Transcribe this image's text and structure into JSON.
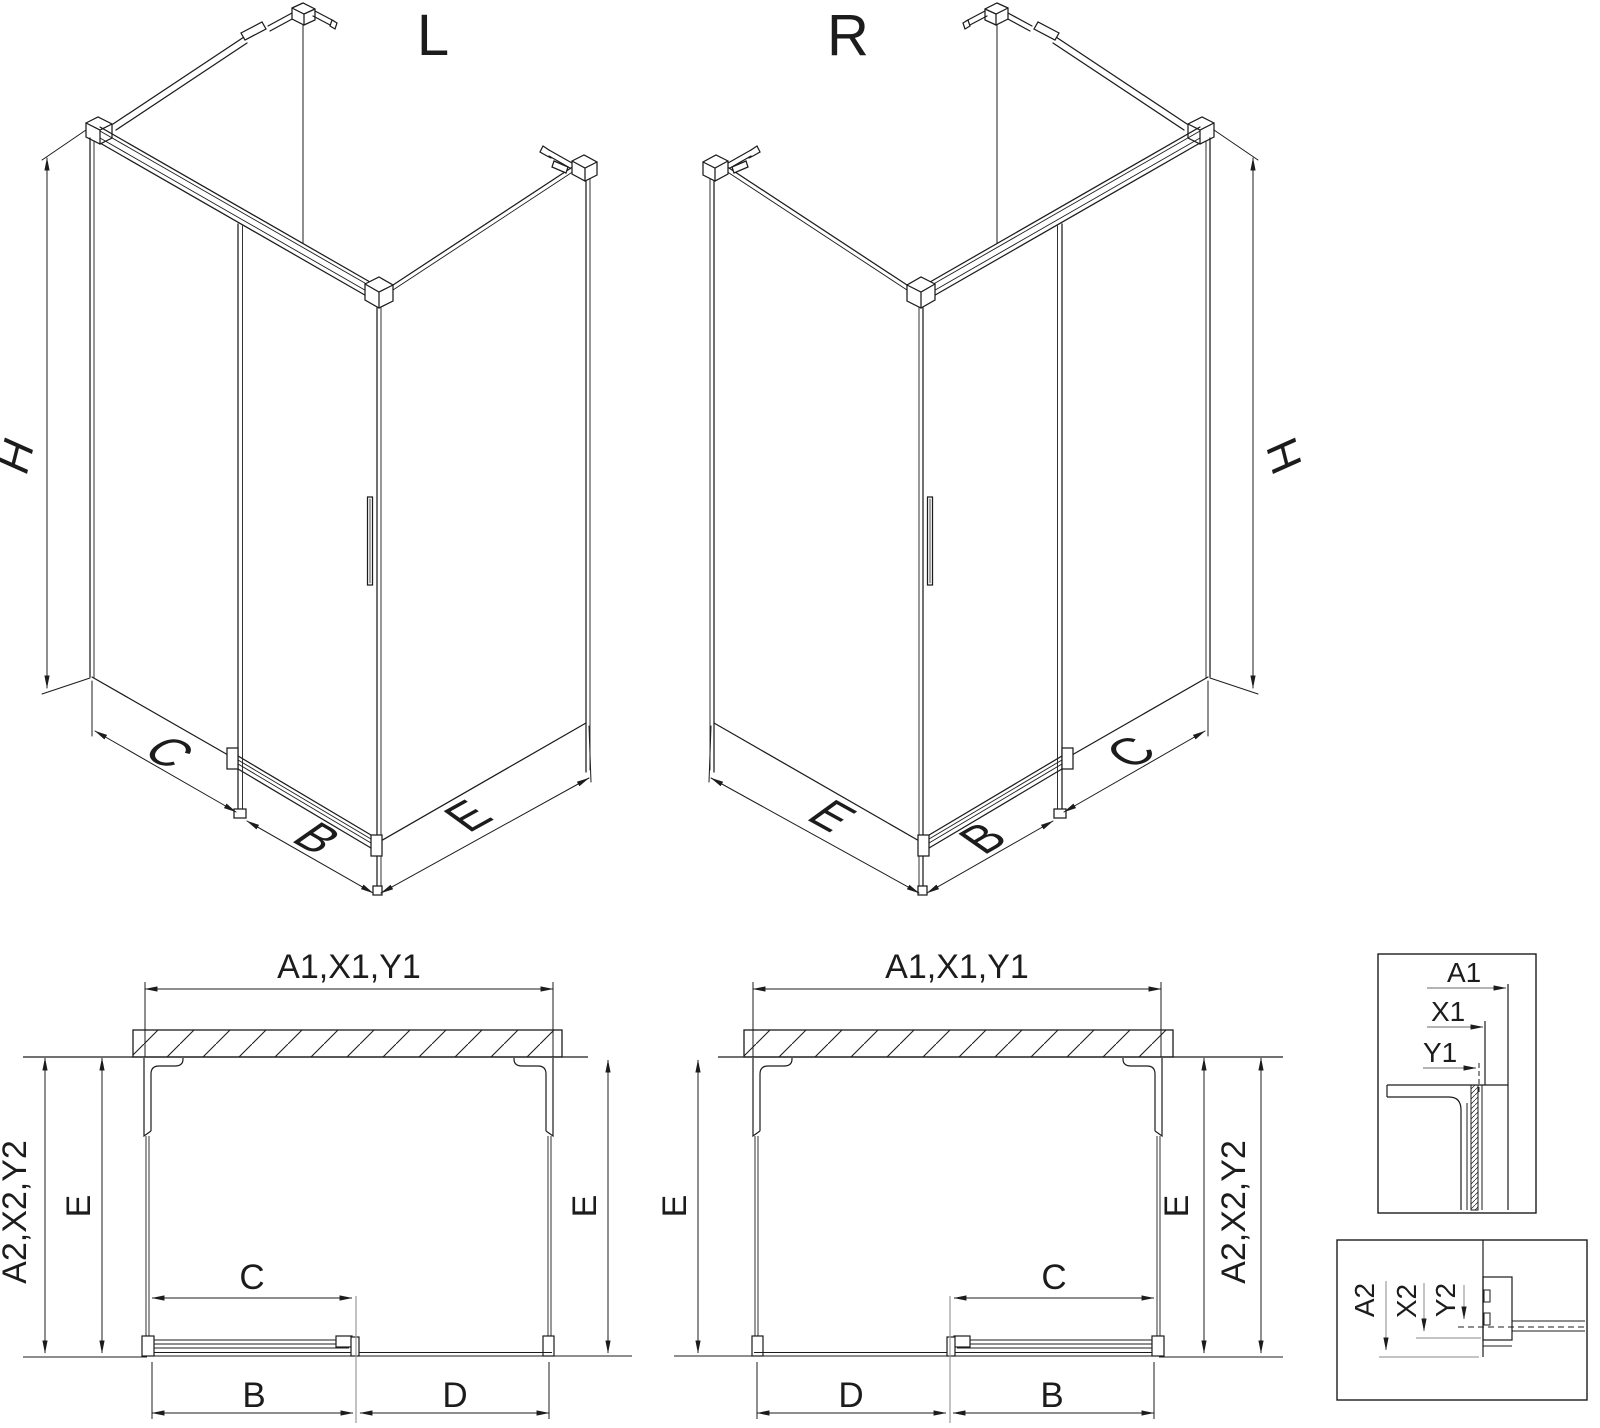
{
  "colors": {
    "background": "#ffffff",
    "line": "#1c1c1c",
    "divider_gray": "#9a9a9a",
    "detail_label_top": "#6a6a6a",
    "detail_label_bottom": "#8a8a8a"
  },
  "iso_views": {
    "left": {
      "title": "L",
      "dim_height": "H",
      "dim_wall": "C",
      "dim_door": "B",
      "dim_side": "E"
    },
    "right": {
      "title": "R",
      "dim_height": "H",
      "dim_wall": "C",
      "dim_door": "B",
      "dim_side": "E"
    }
  },
  "plan_views": {
    "left": {
      "dim_width_outer": "A1,X1,Y1",
      "dim_depth_outer": "A2,X2,Y2",
      "dim_depth_left": "E",
      "dim_depth_right": "E",
      "dim_travel": "C",
      "dim_door": "B",
      "dim_fixed": "D"
    },
    "right": {
      "dim_width_outer": "A1,X1,Y1",
      "dim_depth_outer": "A2,X2,Y2",
      "dim_depth_left": "E",
      "dim_depth_right": "E",
      "dim_travel": "C",
      "dim_door": "B",
      "dim_fixed": "D"
    }
  },
  "details": {
    "top": {
      "dim_a": "A1",
      "dim_x": "X1",
      "dim_y": "Y1"
    },
    "bottom": {
      "dim_a": "A2",
      "dim_x": "X2",
      "dim_y": "Y2"
    }
  }
}
